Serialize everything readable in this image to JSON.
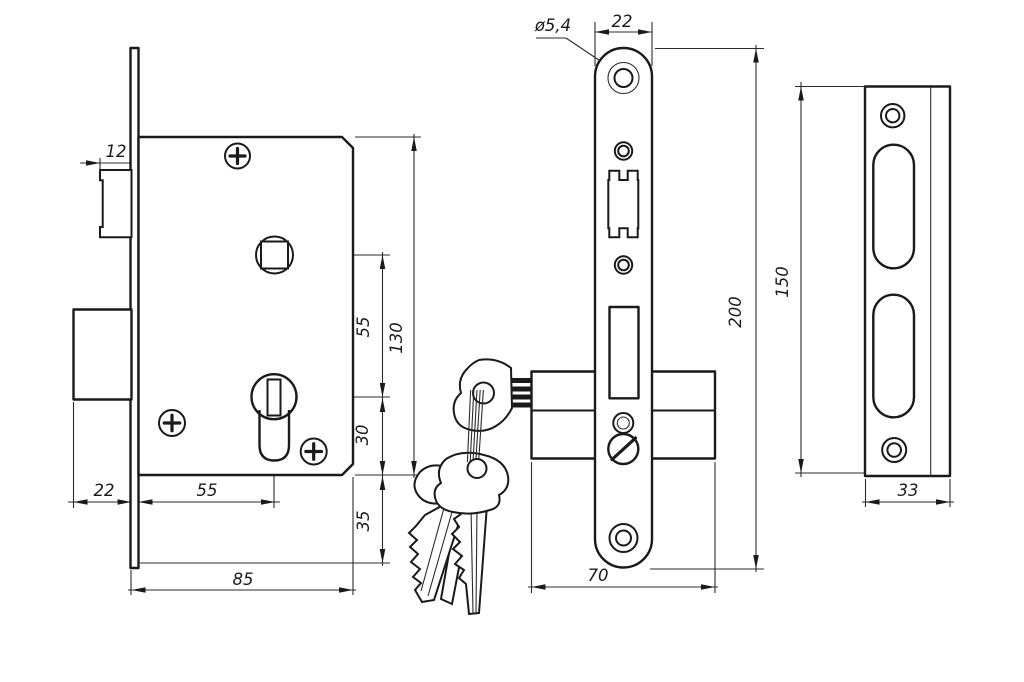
{
  "drawing": {
    "type": "mortise-lock-technical-drawing",
    "colors": {
      "line": "#1a1a1a",
      "background": "#ffffff"
    },
    "views": {
      "side": {
        "dims": {
          "latch_protrusion": "12",
          "bolt_throw": "22",
          "backset": "55",
          "body_depth": "85",
          "spindle_to_cylinder": "55",
          "body_height": "130",
          "cylinder_to_edge": "30",
          "edge_to_plate_end": "35"
        }
      },
      "front": {
        "dims": {
          "hole_diameter": "ø5,4",
          "plate_width": "22",
          "plate_height": "200",
          "cylinder_length": "70"
        }
      },
      "strike": {
        "dims": {
          "plate_height": "150",
          "plate_width": "33"
        }
      }
    }
  }
}
